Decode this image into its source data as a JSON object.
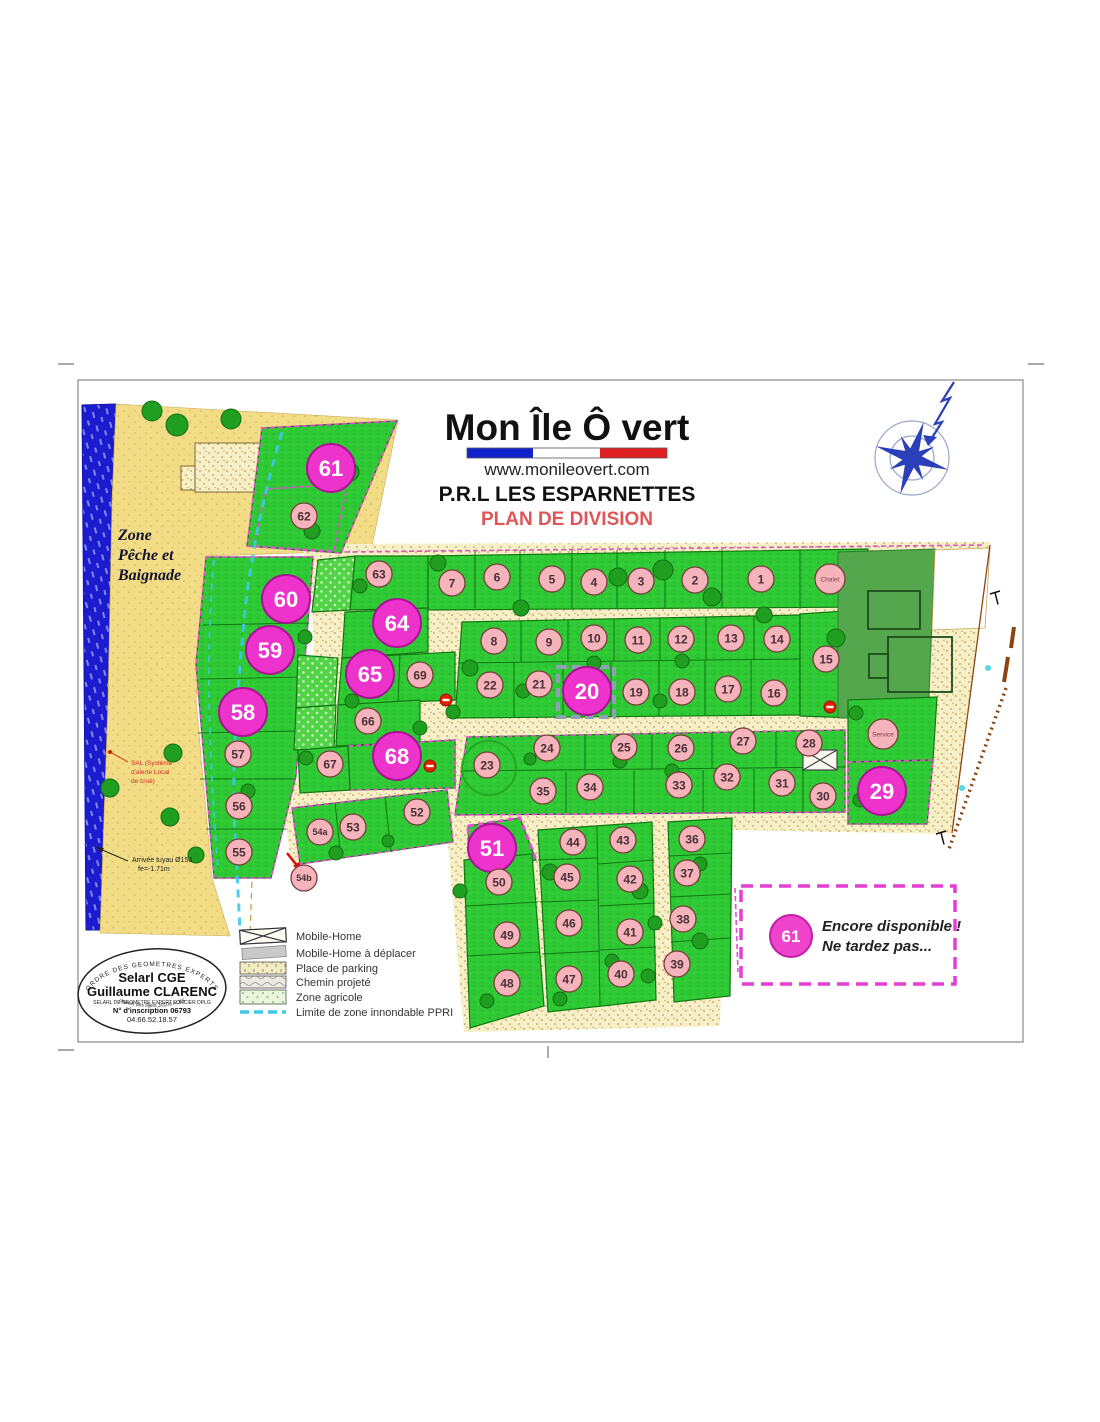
{
  "page": {
    "title_brand": "Mon Île Ô vert",
    "website": "www.monileovert.com",
    "subtitle": "P.R.L LES ESPARNETTES",
    "plan_label": "PLAN DE DIVISION"
  },
  "zone_label": {
    "l1": "Zone",
    "l2": "Pêche et",
    "l3": "Baignade"
  },
  "annotations": {
    "sal_l1": "SAL (Système",
    "sal_l2": "d'alerte Local",
    "sal_l3": "de crue)",
    "pipe_l1": "Arrivée tuyau Ø150",
    "pipe_l2": "fe=-1.71m"
  },
  "legend": {
    "items": [
      {
        "label": "Mobile-Home"
      },
      {
        "label": "Mobile-Home à déplacer"
      },
      {
        "label": "Place de parking"
      },
      {
        "label": "Chemin projeté"
      },
      {
        "label": "Zone agricole"
      },
      {
        "label": "Limite de zone innondable PPRI"
      }
    ]
  },
  "stamp": {
    "arc_top": "ORDRE DES GEOMETRES EXPERTS",
    "line1": "Selarl CGE",
    "line2": "Guillaume CLARENC",
    "line3": "SELARL DE GEOMETRE EXPERT FONCIER DPLG",
    "line4": "N° d'inscription 06793",
    "line5": "04.66.52.18.57",
    "arc_bottom": "chemin des Illiers 30100 ALES"
  },
  "availability": {
    "lot": "61",
    "line1": "Encore disponible !",
    "line2": "Ne tardez pas..."
  },
  "map": {
    "lots": [
      {
        "n": "61",
        "x": 331,
        "y": 468,
        "big": true
      },
      {
        "n": "60",
        "x": 286,
        "y": 599,
        "big": true
      },
      {
        "n": "59",
        "x": 270,
        "y": 650,
        "big": true
      },
      {
        "n": "58",
        "x": 243,
        "y": 712,
        "big": true
      },
      {
        "n": "64",
        "x": 397,
        "y": 623,
        "big": true
      },
      {
        "n": "65",
        "x": 370,
        "y": 674,
        "big": true
      },
      {
        "n": "68",
        "x": 397,
        "y": 756,
        "big": true
      },
      {
        "n": "20",
        "x": 587,
        "y": 691,
        "big": true
      },
      {
        "n": "51",
        "x": 492,
        "y": 848,
        "big": true
      },
      {
        "n": "29",
        "x": 882,
        "y": 791,
        "big": true
      },
      {
        "n": "62",
        "x": 304,
        "y": 516
      },
      {
        "n": "63",
        "x": 379,
        "y": 574
      },
      {
        "n": "7",
        "x": 452,
        "y": 583
      },
      {
        "n": "6",
        "x": 497,
        "y": 577
      },
      {
        "n": "5",
        "x": 552,
        "y": 579
      },
      {
        "n": "4",
        "x": 594,
        "y": 582
      },
      {
        "n": "3",
        "x": 641,
        "y": 581
      },
      {
        "n": "2",
        "x": 695,
        "y": 580
      },
      {
        "n": "1",
        "x": 761,
        "y": 579
      },
      {
        "n": "Chalet",
        "x": 830,
        "y": 579
      },
      {
        "n": "8",
        "x": 494,
        "y": 641
      },
      {
        "n": "9",
        "x": 549,
        "y": 642
      },
      {
        "n": "10",
        "x": 594,
        "y": 638
      },
      {
        "n": "11",
        "x": 638,
        "y": 640
      },
      {
        "n": "12",
        "x": 681,
        "y": 639
      },
      {
        "n": "13",
        "x": 731,
        "y": 638
      },
      {
        "n": "14",
        "x": 777,
        "y": 639
      },
      {
        "n": "15",
        "x": 826,
        "y": 659
      },
      {
        "n": "22",
        "x": 490,
        "y": 685
      },
      {
        "n": "21",
        "x": 539,
        "y": 684
      },
      {
        "n": "19",
        "x": 636,
        "y": 692
      },
      {
        "n": "18",
        "x": 682,
        "y": 692
      },
      {
        "n": "17",
        "x": 728,
        "y": 689
      },
      {
        "n": "16",
        "x": 774,
        "y": 693
      },
      {
        "n": "69",
        "x": 420,
        "y": 675
      },
      {
        "n": "66",
        "x": 368,
        "y": 721
      },
      {
        "n": "67",
        "x": 330,
        "y": 764
      },
      {
        "n": "23",
        "x": 487,
        "y": 765
      },
      {
        "n": "24",
        "x": 547,
        "y": 748
      },
      {
        "n": "25",
        "x": 624,
        "y": 747
      },
      {
        "n": "26",
        "x": 681,
        "y": 748
      },
      {
        "n": "27",
        "x": 743,
        "y": 741
      },
      {
        "n": "28",
        "x": 809,
        "y": 743
      },
      {
        "n": "Service",
        "x": 883,
        "y": 734
      },
      {
        "n": "35",
        "x": 543,
        "y": 791
      },
      {
        "n": "34",
        "x": 590,
        "y": 787
      },
      {
        "n": "33",
        "x": 679,
        "y": 785
      },
      {
        "n": "32",
        "x": 727,
        "y": 777
      },
      {
        "n": "31",
        "x": 782,
        "y": 783
      },
      {
        "n": "30",
        "x": 823,
        "y": 796
      },
      {
        "n": "57",
        "x": 238,
        "y": 754
      },
      {
        "n": "56",
        "x": 239,
        "y": 806
      },
      {
        "n": "55",
        "x": 239,
        "y": 852
      },
      {
        "n": "54a",
        "x": 320,
        "y": 832
      },
      {
        "n": "54b",
        "x": 304,
        "y": 878
      },
      {
        "n": "53",
        "x": 353,
        "y": 827
      },
      {
        "n": "52",
        "x": 417,
        "y": 812
      },
      {
        "n": "50",
        "x": 499,
        "y": 882
      },
      {
        "n": "49",
        "x": 507,
        "y": 935
      },
      {
        "n": "48",
        "x": 507,
        "y": 983
      },
      {
        "n": "44",
        "x": 573,
        "y": 842
      },
      {
        "n": "45",
        "x": 567,
        "y": 877
      },
      {
        "n": "46",
        "x": 569,
        "y": 923
      },
      {
        "n": "47",
        "x": 569,
        "y": 979
      },
      {
        "n": "43",
        "x": 623,
        "y": 840
      },
      {
        "n": "42",
        "x": 630,
        "y": 879
      },
      {
        "n": "41",
        "x": 630,
        "y": 932
      },
      {
        "n": "40",
        "x": 621,
        "y": 974
      },
      {
        "n": "36",
        "x": 692,
        "y": 839
      },
      {
        "n": "37",
        "x": 687,
        "y": 873
      },
      {
        "n": "38",
        "x": 683,
        "y": 919
      },
      {
        "n": "39",
        "x": 677,
        "y": 964
      }
    ],
    "trees": [
      [
        152,
        411,
        10
      ],
      [
        177,
        425,
        11
      ],
      [
        231,
        419,
        10
      ],
      [
        350,
        472,
        9
      ],
      [
        312,
        531,
        8
      ],
      [
        360,
        586,
        7
      ],
      [
        438,
        563,
        8
      ],
      [
        521,
        608,
        8
      ],
      [
        618,
        577,
        9
      ],
      [
        663,
        570,
        10
      ],
      [
        712,
        597,
        9
      ],
      [
        764,
        615,
        8
      ],
      [
        836,
        638,
        9
      ],
      [
        550,
        640,
        7
      ],
      [
        594,
        663,
        7
      ],
      [
        682,
        661,
        7
      ],
      [
        470,
        668,
        8
      ],
      [
        453,
        712,
        7
      ],
      [
        523,
        691,
        7
      ],
      [
        575,
        701,
        7
      ],
      [
        660,
        701,
        7
      ],
      [
        305,
        637,
        7
      ],
      [
        352,
        701,
        7
      ],
      [
        420,
        728,
        7
      ],
      [
        306,
        758,
        7
      ],
      [
        530,
        759,
        6
      ],
      [
        620,
        761,
        7
      ],
      [
        672,
        771,
        7
      ],
      [
        731,
        771,
        6
      ],
      [
        856,
        713,
        7
      ],
      [
        860,
        800,
        7
      ],
      [
        248,
        791,
        7
      ],
      [
        336,
        853,
        7
      ],
      [
        388,
        841,
        6
      ],
      [
        460,
        891,
        7
      ],
      [
        550,
        872,
        8
      ],
      [
        640,
        891,
        8
      ],
      [
        655,
        923,
        7
      ],
      [
        700,
        941,
        8
      ],
      [
        560,
        999,
        7
      ],
      [
        487,
        1001,
        7
      ],
      [
        648,
        976,
        7
      ],
      [
        173,
        753,
        9
      ],
      [
        110,
        788,
        9
      ],
      [
        170,
        817,
        9
      ],
      [
        196,
        855,
        8
      ],
      [
        700,
        864,
        7
      ],
      [
        612,
        961,
        7
      ]
    ],
    "red_markers": [
      [
        446,
        700
      ],
      [
        430,
        766
      ],
      [
        830,
        707
      ]
    ],
    "cyan_dots": [
      [
        988,
        668
      ],
      [
        962,
        788
      ]
    ]
  },
  "colors": {
    "available_fill": "#ee33cc",
    "available_stroke": "#aa1195",
    "lot_circle_fill": "#f5b3bb",
    "lot_circle_stroke": "#7a3b3b",
    "green": "#33cc33",
    "sand": "#f2de8c",
    "road": "#f6efc4",
    "water": "#1c1cce",
    "magenta_dash": "#e44fd0",
    "ppri": "#3fc8e8",
    "title_red": "#e05555"
  }
}
